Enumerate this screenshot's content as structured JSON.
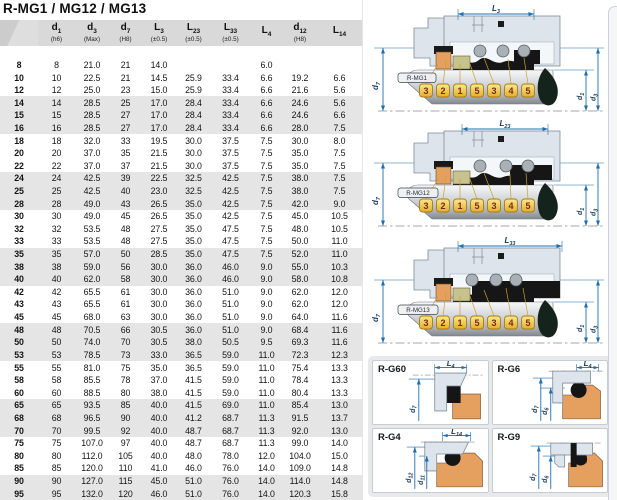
{
  "title": "R-MG1 / MG12 / MG13",
  "colors": {
    "accent": "#1f6fad",
    "housing": "#dde4eb",
    "orange": "#e5a05f",
    "tan": "#c8c28c",
    "tagBorder": "#aa7d12",
    "tagText": "#7c2c0e",
    "headerBg": "#d9d9d9",
    "rowAlt": "#e5e5e5",
    "rubber": "#161616",
    "drop": "#15231d",
    "panelBg": "#e7e9eb",
    "dimText": "#16395c"
  },
  "table": {
    "columns": [
      {
        "base": "",
        "sub": "",
        "note": ""
      },
      {
        "base": "d",
        "sub": "1",
        "note": "(h6)"
      },
      {
        "base": "d",
        "sub": "3",
        "note": "(Max)"
      },
      {
        "base": "d",
        "sub": "7",
        "note": "(H8)"
      },
      {
        "base": "L",
        "sub": "3",
        "note": "(±0.5)"
      },
      {
        "base": "L",
        "sub": "23",
        "note": "(±0.5)"
      },
      {
        "base": "L",
        "sub": "33",
        "note": "(±0.5)"
      },
      {
        "base": "L",
        "sub": "4",
        "note": ""
      },
      {
        "base": "d",
        "sub": "12",
        "note": "(H8)"
      },
      {
        "base": "L",
        "sub": "14",
        "note": ""
      }
    ],
    "rows": [
      [
        "8",
        "8",
        "21.0",
        "21",
        "14.0",
        "",
        "",
        "6.0",
        "",
        ""
      ],
      [
        "10",
        "10",
        "22.5",
        "21",
        "14.5",
        "25.9",
        "33.4",
        "6.6",
        "19.2",
        "6.6"
      ],
      [
        "12",
        "12",
        "25.0",
        "23",
        "15.0",
        "25.9",
        "33.4",
        "6.6",
        "21.6",
        "5.6"
      ],
      [
        "14",
        "14",
        "28.5",
        "25",
        "17.0",
        "28.4",
        "33.4",
        "6.6",
        "24.6",
        "5.6"
      ],
      [
        "15",
        "15",
        "28.5",
        "27",
        "17.0",
        "28.4",
        "33.4",
        "6.6",
        "24.6",
        "6.6"
      ],
      [
        "16",
        "16",
        "28.5",
        "27",
        "17.0",
        "28.4",
        "33.4",
        "6.6",
        "28.0",
        "7.5"
      ],
      [
        "18",
        "18",
        "32.0",
        "33",
        "19.5",
        "30.0",
        "37.5",
        "7.5",
        "30.0",
        "8.0"
      ],
      [
        "20",
        "20",
        "37.0",
        "35",
        "21.5",
        "30.0",
        "37.5",
        "7.5",
        "35.0",
        "7.5"
      ],
      [
        "22",
        "22",
        "37.0",
        "37",
        "21.5",
        "30.0",
        "37.5",
        "7.5",
        "35.0",
        "7.5"
      ],
      [
        "24",
        "24",
        "42.5",
        "39",
        "22.5",
        "32.5",
        "42.5",
        "7.5",
        "38.0",
        "7.5"
      ],
      [
        "25",
        "25",
        "42.5",
        "40",
        "23.0",
        "32.5",
        "42.5",
        "7.5",
        "38.0",
        "7.5"
      ],
      [
        "28",
        "28",
        "49.0",
        "43",
        "26.5",
        "35.0",
        "42.5",
        "7.5",
        "42.0",
        "9.0"
      ],
      [
        "30",
        "30",
        "49.0",
        "45",
        "26.5",
        "35.0",
        "42.5",
        "7.5",
        "45.0",
        "10.5"
      ],
      [
        "32",
        "32",
        "53.5",
        "48",
        "27.5",
        "35.0",
        "47.5",
        "7.5",
        "48.0",
        "10.5"
      ],
      [
        "33",
        "33",
        "53.5",
        "48",
        "27.5",
        "35.0",
        "47.5",
        "7.5",
        "50.0",
        "11.0"
      ],
      [
        "35",
        "35",
        "57.0",
        "50",
        "28.5",
        "35.0",
        "47.5",
        "7.5",
        "52.0",
        "11.0"
      ],
      [
        "38",
        "38",
        "59.0",
        "56",
        "30.0",
        "36.0",
        "46.0",
        "9.0",
        "55.0",
        "10.3"
      ],
      [
        "40",
        "40",
        "62.0",
        "58",
        "30.0",
        "36.0",
        "46.0",
        "9.0",
        "58.0",
        "10.8"
      ],
      [
        "42",
        "42",
        "65.5",
        "61",
        "30.0",
        "36.0",
        "51.0",
        "9.0",
        "62.0",
        "12.0"
      ],
      [
        "43",
        "43",
        "65.5",
        "61",
        "30.0",
        "36.0",
        "51.0",
        "9.0",
        "62.0",
        "12.0"
      ],
      [
        "45",
        "45",
        "68.0",
        "63",
        "30.0",
        "36.0",
        "51.0",
        "9.0",
        "64.0",
        "11.6"
      ],
      [
        "48",
        "48",
        "70.5",
        "66",
        "30.5",
        "36.0",
        "51.0",
        "9.0",
        "68.4",
        "11.6"
      ],
      [
        "50",
        "50",
        "74.0",
        "70",
        "30.5",
        "38.0",
        "50.5",
        "9.5",
        "69.3",
        "11.6"
      ],
      [
        "53",
        "53",
        "78.5",
        "73",
        "33.0",
        "36.5",
        "59.0",
        "11.0",
        "72.3",
        "12.3"
      ],
      [
        "55",
        "55",
        "81.0",
        "75",
        "35.0",
        "36.5",
        "59.0",
        "11.0",
        "75.4",
        "13.3"
      ],
      [
        "58",
        "58",
        "85.5",
        "78",
        "37.0",
        "41.5",
        "59.0",
        "11.0",
        "78.4",
        "13.3"
      ],
      [
        "60",
        "60",
        "88.5",
        "80",
        "38.0",
        "41.5",
        "59.0",
        "11.0",
        "80.4",
        "13.3"
      ],
      [
        "65",
        "65",
        "93.5",
        "85",
        "40.0",
        "41.5",
        "69.0",
        "11.0",
        "85.4",
        "13.0"
      ],
      [
        "68",
        "68",
        "96.5",
        "90",
        "40.0",
        "41.2",
        "68.7",
        "11.3",
        "91.5",
        "13.7"
      ],
      [
        "70",
        "70",
        "99.5",
        "92",
        "40.0",
        "48.7",
        "68.7",
        "11.3",
        "92.0",
        "13.0"
      ],
      [
        "75",
        "75",
        "107.0",
        "97",
        "40.0",
        "48.7",
        "68.7",
        "11.3",
        "99.0",
        "14.0"
      ],
      [
        "80",
        "80",
        "112.0",
        "105",
        "40.0",
        "48.0",
        "78.0",
        "12.0",
        "104.0",
        "15.0"
      ],
      [
        "85",
        "85",
        "120.0",
        "110",
        "41.0",
        "46.0",
        "76.0",
        "14.0",
        "109.0",
        "14.8"
      ],
      [
        "90",
        "90",
        "127.0",
        "115",
        "45.0",
        "51.0",
        "76.0",
        "14.0",
        "114.0",
        "14.8"
      ],
      [
        "95",
        "95",
        "132.0",
        "120",
        "46.0",
        "51.0",
        "76.0",
        "14.0",
        "120.3",
        "15.8"
      ],
      [
        "100",
        "100",
        "137.0",
        "125",
        "47.0",
        "51.0",
        "76.0",
        "14.0",
        "123.3",
        "15.8"
      ]
    ]
  },
  "diagrams": {
    "tags": [
      "3",
      "2",
      "1",
      "5",
      "3",
      "4",
      "5"
    ],
    "d7": {
      "base": "d",
      "sub": "7"
    },
    "d1": {
      "base": "d",
      "sub": "1"
    },
    "d3": {
      "base": "d",
      "sub": "3"
    },
    "items": [
      {
        "name": "R-MG1",
        "dim": {
          "base": "L",
          "sub": "3"
        }
      },
      {
        "name": "R-MG12",
        "dim": {
          "base": "L",
          "sub": "23"
        }
      },
      {
        "name": "R-MG13",
        "dim": {
          "base": "L",
          "sub": "33"
        }
      }
    ]
  },
  "seat_panel": {
    "items": [
      {
        "name": "R-G60",
        "dim": {
          "base": "L",
          "sub": "4"
        },
        "dias": [
          {
            "base": "d",
            "sub": "7"
          }
        ]
      },
      {
        "name": "R-G6",
        "dim": {
          "base": "L",
          "sub": "4"
        },
        "dias": [
          {
            "base": "d",
            "sub": "7"
          },
          {
            "base": "d",
            "sub": "6"
          }
        ]
      },
      {
        "name": "R-G4",
        "dim": {
          "base": "L",
          "sub": "14"
        },
        "dias": [
          {
            "base": "d",
            "sub": "12"
          },
          {
            "base": "d",
            "sub": "11"
          }
        ]
      },
      {
        "name": "R-G9",
        "dim": null,
        "dias": [
          {
            "base": "d",
            "sub": "7"
          },
          {
            "base": "d",
            "sub": "6"
          }
        ]
      }
    ]
  }
}
